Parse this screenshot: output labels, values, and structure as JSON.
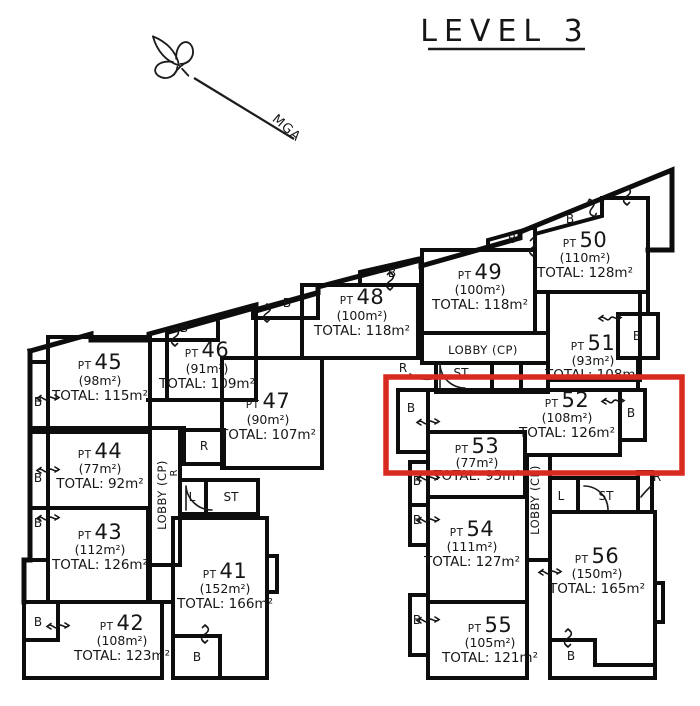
{
  "title": "LEVEL 3",
  "north": {
    "label": "MGA"
  },
  "rooms": {
    "balcony": "B",
    "riser": "R",
    "lift": "L",
    "store": "ST",
    "lobby": "LOBBY (CP)"
  },
  "highlight": {
    "color": "#d92a20",
    "units": "PT 52, PT 53"
  },
  "units": [
    {
      "prefix": "PT",
      "num": "41",
      "area": "(152m²)",
      "total": "TOTAL: 166m²"
    },
    {
      "prefix": "PT",
      "num": "42",
      "area": "(108m²)",
      "total": "TOTAL: 123m²"
    },
    {
      "prefix": "PT",
      "num": "43",
      "area": "(112m²)",
      "total": "TOTAL: 126m²"
    },
    {
      "prefix": "PT",
      "num": "44",
      "area": "(77m²)",
      "total": "TOTAL: 92m²"
    },
    {
      "prefix": "PT",
      "num": "45",
      "area": "(98m²)",
      "total": "TOTAL: 115m²"
    },
    {
      "prefix": "PT",
      "num": "46",
      "area": "(91m²)",
      "total": "TOTAL: 109m²"
    },
    {
      "prefix": "PT",
      "num": "47",
      "area": "(90m²)",
      "total": "TOTAL: 107m²"
    },
    {
      "prefix": "PT",
      "num": "48",
      "area": "(100m²)",
      "total": "TOTAL: 118m²"
    },
    {
      "prefix": "PT",
      "num": "49",
      "area": "(100m²)",
      "total": "TOTAL: 118m²"
    },
    {
      "prefix": "PT",
      "num": "50",
      "area": "(110m²)",
      "total": "TOTAL: 128m²"
    },
    {
      "prefix": "PT",
      "num": "51",
      "area": "(93m²)",
      "total": "TOTAL: 108m²"
    },
    {
      "prefix": "PT",
      "num": "52",
      "area": "(108m²)",
      "total": "TOTAL: 126m²"
    },
    {
      "prefix": "PT",
      "num": "53",
      "area": "(77m²)",
      "total": "TOTAL: 95m²"
    },
    {
      "prefix": "PT",
      "num": "54",
      "area": "(111m²)",
      "total": "TOTAL: 127m²"
    },
    {
      "prefix": "PT",
      "num": "55",
      "area": "(105m²)",
      "total": "TOTAL: 121m²"
    },
    {
      "prefix": "PT",
      "num": "56",
      "area": "(150m²)",
      "total": "TOTAL: 165m²"
    }
  ]
}
